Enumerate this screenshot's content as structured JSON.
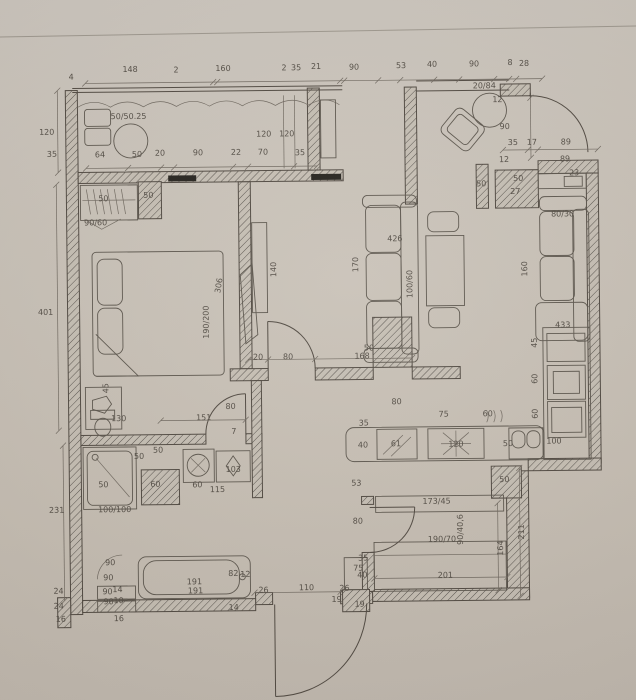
{
  "meta": {
    "drawing_type": "apartment floor plan scan",
    "units": "cm"
  },
  "colors": {
    "paper": "#c9c2b8",
    "ink": "#4e473f",
    "ink_soft": "#6e675e",
    "black_fill": "#23201b"
  },
  "labels": [
    {
      "t": "148",
      "x": 133,
      "y": 70
    },
    {
      "t": "2",
      "x": 179,
      "y": 71
    },
    {
      "t": "160",
      "x": 226,
      "y": 70
    },
    {
      "t": "2",
      "x": 287,
      "y": 70
    },
    {
      "t": "35",
      "x": 299,
      "y": 70
    },
    {
      "t": "21",
      "x": 319,
      "y": 69
    },
    {
      "t": "90",
      "x": 357,
      "y": 70
    },
    {
      "t": "53",
      "x": 404,
      "y": 69
    },
    {
      "t": "40",
      "x": 435,
      "y": 68
    },
    {
      "t": "90",
      "x": 477,
      "y": 68
    },
    {
      "t": "8",
      "x": 513,
      "y": 67
    },
    {
      "t": "28",
      "x": 527,
      "y": 68
    },
    {
      "t": "4",
      "x": 74,
      "y": 77
    },
    {
      "t": "120",
      "x": 49,
      "y": 132
    },
    {
      "t": "50/50.25",
      "x": 131,
      "y": 117
    },
    {
      "t": "120",
      "x": 266,
      "y": 136
    },
    {
      "t": "120",
      "x": 289,
      "y": 136
    },
    {
      "t": "20/84",
      "x": 487,
      "y": 90
    },
    {
      "t": "12",
      "x": 500,
      "y": 104
    },
    {
      "t": "90",
      "x": 507,
      "y": 131
    },
    {
      "t": "35",
      "x": 54,
      "y": 154
    },
    {
      "t": "64",
      "x": 102,
      "y": 155
    },
    {
      "t": "50",
      "x": 139,
      "y": 155
    },
    {
      "t": "20",
      "x": 162,
      "y": 154
    },
    {
      "t": "90",
      "x": 200,
      "y": 154
    },
    {
      "t": "22",
      "x": 238,
      "y": 154
    },
    {
      "t": "70",
      "x": 265,
      "y": 154
    },
    {
      "t": "35",
      "x": 302,
      "y": 155
    },
    {
      "t": "35",
      "x": 515,
      "y": 147
    },
    {
      "t": "17",
      "x": 534,
      "y": 147
    },
    {
      "t": "89",
      "x": 568,
      "y": 147
    },
    {
      "t": "89",
      "x": 567,
      "y": 164
    },
    {
      "t": "12",
      "x": 506,
      "y": 164
    },
    {
      "t": "23",
      "x": 576,
      "y": 178
    },
    {
      "t": "50",
      "x": 483,
      "y": 188
    },
    {
      "t": "50",
      "x": 520,
      "y": 183
    },
    {
      "t": "27",
      "x": 517,
      "y": 196
    },
    {
      "t": "50",
      "x": 105,
      "y": 199
    },
    {
      "t": "50",
      "x": 150,
      "y": 196
    },
    {
      "t": "90/60",
      "x": 97,
      "y": 223
    },
    {
      "t": "401",
      "x": 46,
      "y": 312
    },
    {
      "t": "306",
      "x": 222,
      "y": 285,
      "r": -80
    },
    {
      "t": "190/200",
      "x": 209,
      "y": 321,
      "r": -90
    },
    {
      "t": "140",
      "x": 277,
      "y": 269,
      "r": -90
    },
    {
      "t": "426",
      "x": 396,
      "y": 242
    },
    {
      "t": "170",
      "x": 359,
      "y": 265,
      "r": -90
    },
    {
      "t": "100/60",
      "x": 413,
      "y": 285,
      "r": -90
    },
    {
      "t": "80/30",
      "x": 564,
      "y": 219
    },
    {
      "t": "160",
      "x": 528,
      "y": 271,
      "r": -90
    },
    {
      "t": "433",
      "x": 563,
      "y": 330
    },
    {
      "t": "45",
      "x": 537,
      "y": 345,
      "r": -90
    },
    {
      "t": "60",
      "x": 537,
      "y": 381,
      "r": -90
    },
    {
      "t": "60",
      "x": 537,
      "y": 416,
      "r": -90
    },
    {
      "t": "45",
      "x": 108,
      "y": 386,
      "r": -90
    },
    {
      "t": "130",
      "x": 118,
      "y": 419
    },
    {
      "t": "151",
      "x": 203,
      "y": 419
    },
    {
      "t": "7",
      "x": 233,
      "y": 433
    },
    {
      "t": "80",
      "x": 230,
      "y": 408
    },
    {
      "t": "20",
      "x": 258,
      "y": 359
    },
    {
      "t": "80",
      "x": 288,
      "y": 359
    },
    {
      "t": "168",
      "x": 362,
      "y": 359
    },
    {
      "t": "50",
      "x": 369,
      "y": 351
    },
    {
      "t": "35",
      "x": 363,
      "y": 426
    },
    {
      "t": "80",
      "x": 396,
      "y": 405
    },
    {
      "t": "75",
      "x": 443,
      "y": 418
    },
    {
      "t": "60",
      "x": 487,
      "y": 418
    },
    {
      "t": "40",
      "x": 362,
      "y": 448
    },
    {
      "t": "61",
      "x": 395,
      "y": 447
    },
    {
      "t": "120",
      "x": 455,
      "y": 448
    },
    {
      "t": "50",
      "x": 507,
      "y": 448
    },
    {
      "t": "100",
      "x": 553,
      "y": 446
    },
    {
      "t": "50",
      "x": 503,
      "y": 484
    },
    {
      "t": "53",
      "x": 355,
      "y": 486
    },
    {
      "t": "231",
      "x": 55,
      "y": 510
    },
    {
      "t": "50",
      "x": 157,
      "y": 451
    },
    {
      "t": "50",
      "x": 138,
      "y": 457
    },
    {
      "t": "50",
      "x": 102,
      "y": 485
    },
    {
      "t": "60",
      "x": 154,
      "y": 485
    },
    {
      "t": "60",
      "x": 196,
      "y": 486
    },
    {
      "t": "115",
      "x": 216,
      "y": 491
    },
    {
      "t": "103",
      "x": 232,
      "y": 471
    },
    {
      "t": "100/100",
      "x": 113,
      "y": 510
    },
    {
      "t": "173/45",
      "x": 435,
      "y": 505
    },
    {
      "t": "190/70",
      "x": 440,
      "y": 543
    },
    {
      "t": "90/40,6",
      "x": 461,
      "y": 531,
      "r": -90
    },
    {
      "t": "164",
      "x": 501,
      "y": 550,
      "r": -90
    },
    {
      "t": "211",
      "x": 522,
      "y": 534,
      "r": -90
    },
    {
      "t": "201",
      "x": 443,
      "y": 579
    },
    {
      "t": "80",
      "x": 356,
      "y": 524
    },
    {
      "t": "35",
      "x": 361,
      "y": 561
    },
    {
      "t": "75",
      "x": 356,
      "y": 571
    },
    {
      "t": "40",
      "x": 360,
      "y": 578
    },
    {
      "t": "26",
      "x": 342,
      "y": 591
    },
    {
      "t": "19",
      "x": 334,
      "y": 602
    },
    {
      "t": "19",
      "x": 357,
      "y": 607
    },
    {
      "t": "110",
      "x": 304,
      "y": 590
    },
    {
      "t": "26",
      "x": 261,
      "y": 592
    },
    {
      "t": "90",
      "x": 108,
      "y": 563
    },
    {
      "t": "90",
      "x": 106,
      "y": 578
    },
    {
      "t": "90",
      "x": 105,
      "y": 592
    },
    {
      "t": "14",
      "x": 115,
      "y": 590
    },
    {
      "t": "90",
      "x": 106,
      "y": 602
    },
    {
      "t": "10",
      "x": 116,
      "y": 601
    },
    {
      "t": "16",
      "x": 116,
      "y": 619
    },
    {
      "t": "24",
      "x": 56,
      "y": 591
    },
    {
      "t": "24",
      "x": 56,
      "y": 606
    },
    {
      "t": "16",
      "x": 58,
      "y": 619
    },
    {
      "t": "191",
      "x": 192,
      "y": 583
    },
    {
      "t": "191",
      "x": 193,
      "y": 592
    },
    {
      "t": "82",
      "x": 231,
      "y": 575
    },
    {
      "t": "12",
      "x": 243,
      "y": 576
    },
    {
      "t": "14",
      "x": 231,
      "y": 609
    }
  ]
}
